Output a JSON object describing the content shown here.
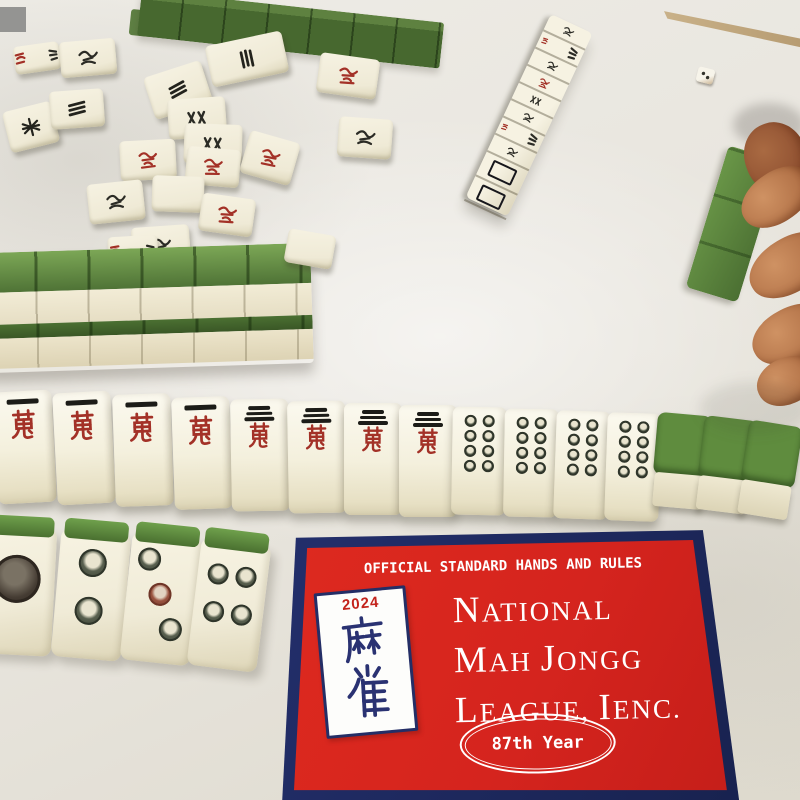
{
  "card": {
    "banner": "OFFICIAL STANDARD HANDS AND RULES",
    "title_lines": [
      [
        {
          "t": "N",
          "big": true
        },
        {
          "t": "ATIONAL",
          "big": false
        }
      ],
      [
        {
          "t": "M",
          "big": true
        },
        {
          "t": "AH ",
          "big": false
        },
        {
          "t": "J",
          "big": true
        },
        {
          "t": "ONGG",
          "big": false
        }
      ],
      [
        {
          "t": "L",
          "big": true
        },
        {
          "t": "EAGUE, ",
          "big": false
        },
        {
          "t": "I",
          "big": true
        },
        {
          "t": "ENC.",
          "big": false
        }
      ]
    ],
    "year_badge": "87th Year",
    "logo": {
      "year": "2024",
      "hanzi": "麻雀"
    },
    "colors": {
      "red": "#d5241e",
      "navy": "#1d2a66",
      "text": "#ffffff"
    }
  },
  "scene": {
    "table_color": "#e9e6df",
    "tile_face_color": "#f2eedd",
    "tile_back_green": "#6b9a4a",
    "wood_edge_color": "#4a2d1e",
    "skin_color": "#c08155"
  },
  "tiles": {
    "exposed_row": [
      {
        "kind": "1-crak",
        "x": -4,
        "y": 391,
        "rot": -3
      },
      {
        "kind": "1-crak",
        "x": 55,
        "y": 392,
        "rot": -3
      },
      {
        "kind": "1-crak",
        "x": 114,
        "y": 394,
        "rot": -2
      },
      {
        "kind": "1-crak",
        "x": 173,
        "y": 397,
        "rot": -2
      },
      {
        "kind": "3-crak",
        "x": 231,
        "y": 399,
        "rot": -1
      },
      {
        "kind": "3-crak",
        "x": 288,
        "y": 401,
        "rot": -1
      },
      {
        "kind": "3-crak",
        "x": 344,
        "y": 403,
        "rot": 0
      },
      {
        "kind": "3-crak",
        "x": 399,
        "y": 405,
        "rot": 0
      },
      {
        "kind": "8-dot",
        "x": 452,
        "y": 407,
        "rot": 1
      },
      {
        "kind": "8-dot",
        "x": 504,
        "y": 409,
        "rot": 1
      },
      {
        "kind": "8-dot",
        "x": 555,
        "y": 411,
        "rot": 2
      },
      {
        "kind": "8-dot",
        "x": 606,
        "y": 413,
        "rot": 2
      },
      {
        "kind": "back",
        "x": 654,
        "y": 414,
        "rot": 5
      },
      {
        "kind": "back",
        "x": 699,
        "y": 418,
        "rot": 7
      },
      {
        "kind": "back",
        "x": 742,
        "y": 423,
        "rot": 9
      }
    ],
    "leaning_row": [
      {
        "kind": "1-dot",
        "x": -16,
        "y": 527,
        "rot": 3
      },
      {
        "kind": "2-dot",
        "x": 56,
        "y": 531,
        "rot": 5
      },
      {
        "kind": "3-dot",
        "x": 126,
        "y": 535,
        "rot": 6
      },
      {
        "kind": "4-dot",
        "x": 194,
        "y": 541,
        "rot": 7
      }
    ],
    "scattered": [
      {
        "x": 14,
        "y": 44,
        "w": 46,
        "h": 28,
        "rot": -8,
        "g": "redblack"
      },
      {
        "x": 60,
        "y": 40,
        "w": 56,
        "h": 36,
        "rot": -5,
        "g": "bird"
      },
      {
        "x": 208,
        "y": 38,
        "w": 78,
        "h": 42,
        "rot": -12,
        "g": "barsV"
      },
      {
        "x": 318,
        "y": 56,
        "w": 60,
        "h": 40,
        "rot": 8,
        "g": "red"
      },
      {
        "x": 6,
        "y": 106,
        "w": 50,
        "h": 42,
        "rot": -14,
        "g": "star"
      },
      {
        "x": 50,
        "y": 90,
        "w": 54,
        "h": 38,
        "rot": -4,
        "g": "barsH"
      },
      {
        "x": 148,
        "y": 68,
        "w": 60,
        "h": 44,
        "rot": -18,
        "g": "barsH"
      },
      {
        "x": 168,
        "y": 98,
        "w": 58,
        "h": 40,
        "rot": -4,
        "g": "xx"
      },
      {
        "x": 184,
        "y": 124,
        "w": 58,
        "h": 40,
        "rot": 2,
        "g": "xx"
      },
      {
        "x": 120,
        "y": 140,
        "w": 56,
        "h": 40,
        "rot": -3,
        "g": "red"
      },
      {
        "x": 186,
        "y": 148,
        "w": 54,
        "h": 38,
        "rot": 5,
        "g": "red"
      },
      {
        "x": 244,
        "y": 136,
        "w": 52,
        "h": 44,
        "rot": 16,
        "g": "red"
      },
      {
        "x": 88,
        "y": 182,
        "w": 56,
        "h": 40,
        "rot": -6,
        "g": "bird"
      },
      {
        "x": 152,
        "y": 176,
        "w": 52,
        "h": 36,
        "rot": 2,
        "g": "plain"
      },
      {
        "x": 200,
        "y": 196,
        "w": 54,
        "h": 38,
        "rot": 8,
        "g": "red"
      },
      {
        "x": 132,
        "y": 226,
        "w": 58,
        "h": 40,
        "rot": -4,
        "g": "bird"
      },
      {
        "x": 338,
        "y": 118,
        "w": 54,
        "h": 40,
        "rot": 4,
        "g": "bird"
      },
      {
        "x": 108,
        "y": 236,
        "w": 50,
        "h": 32,
        "rot": -3,
        "g": "redblack"
      }
    ],
    "wall": {
      "x": -14,
      "y": 248,
      "width": 326,
      "rot": -1.8,
      "segments": 6
    },
    "top_wall": {
      "x": 142,
      "y": -10,
      "length": 304,
      "rot": 6.2,
      "segments": 7
    },
    "standing_column": {
      "x": 551,
      "y": 14,
      "rot": 25,
      "tiles": 10,
      "white_dragons": 2
    },
    "held_tile": {
      "x": 706,
      "y": 150,
      "rot": 17
    }
  },
  "die": {
    "x": 697,
    "y": 68,
    "rot": 14
  }
}
